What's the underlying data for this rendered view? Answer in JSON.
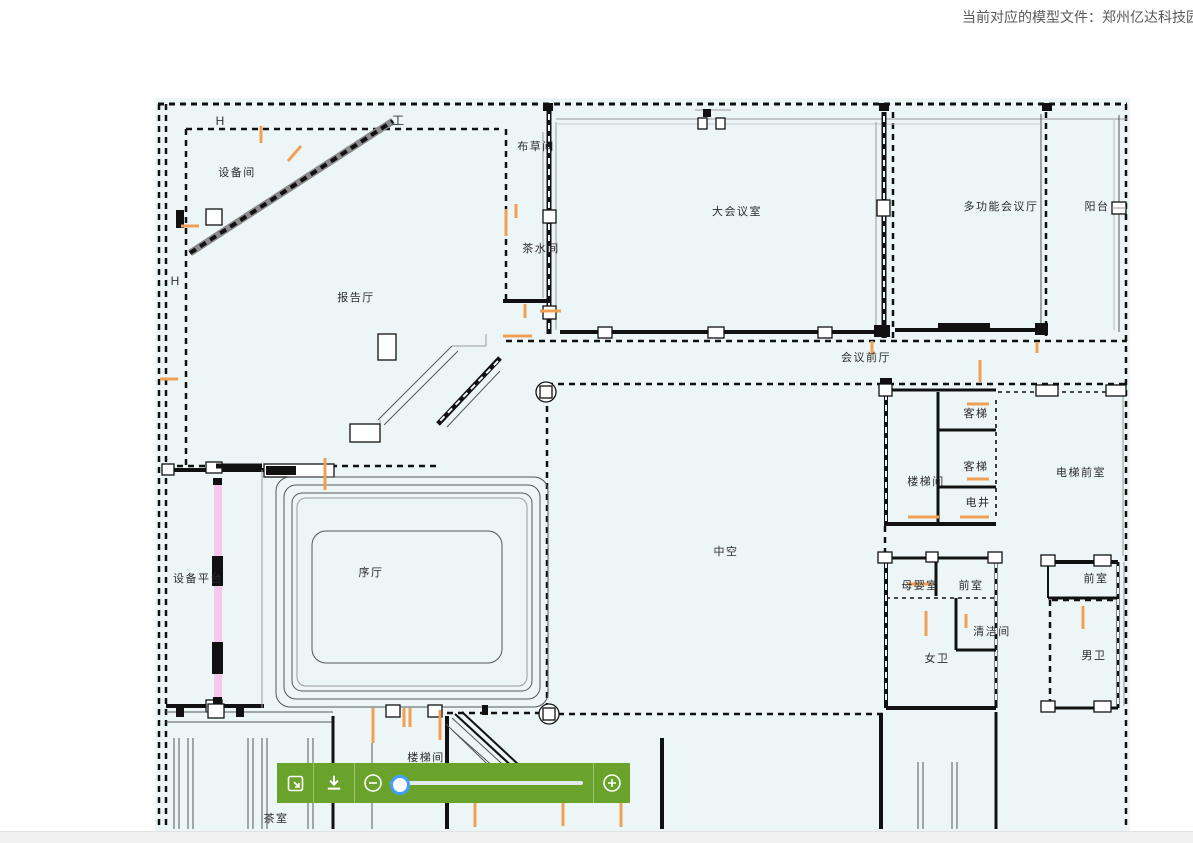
{
  "header": {
    "model_file_text": "当前对应的模型文件：郑州亿达科技园"
  },
  "plan": {
    "background_color": "#edf6f6",
    "accent_orange": "#f0a055",
    "highlight_pink": "#f6c8ee",
    "grid_labels": [
      "H",
      "工",
      "H"
    ],
    "rooms": [
      "设备间",
      "报告厅",
      "布草间",
      "茶水间",
      "大会议室",
      "多功能会议厅",
      "阳台",
      "会议前厅",
      "中空",
      "序厅",
      "设备平台",
      "楼梯间",
      "客梯",
      "客梯",
      "电井",
      "电梯前室",
      "母婴室",
      "前室",
      "清洁间",
      "女卫",
      "前室",
      "男卫",
      "楼梯间",
      "茶室"
    ]
  },
  "toolbar": {
    "background_color": "#6aa32c",
    "icons": [
      "fit-screen-icon",
      "download-icon",
      "zoom-out-icon",
      "zoom-in-icon"
    ],
    "slider": {
      "percent": 4
    }
  }
}
